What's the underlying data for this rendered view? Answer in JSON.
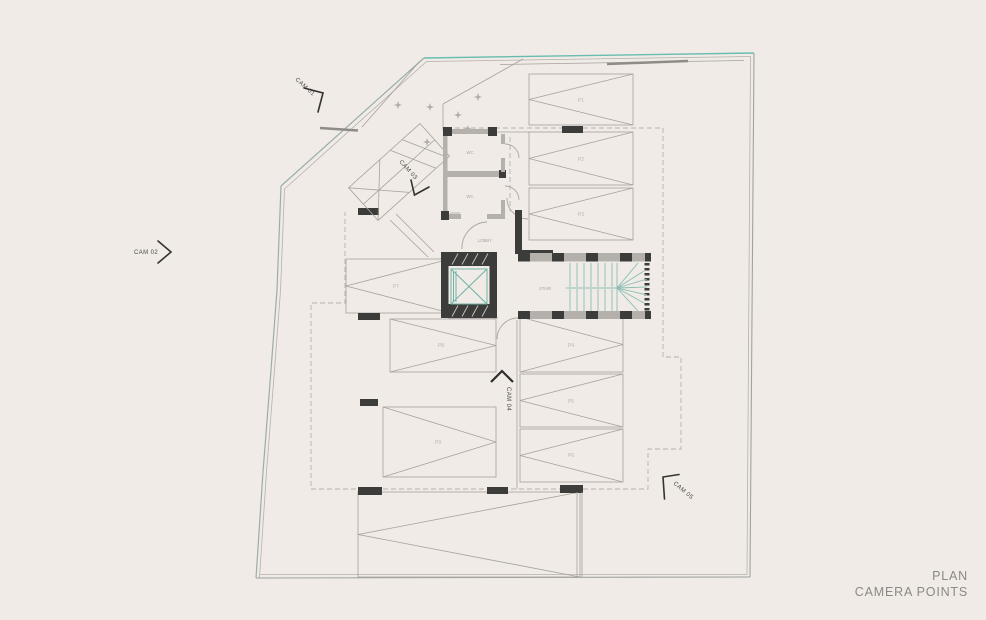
{
  "title_block": {
    "line1": "PLAN",
    "line2": "CAMERA POINTS"
  },
  "cameras": {
    "cam01": "CAM 01",
    "cam02": "CAM 02",
    "cam03": "CAM 03",
    "cam04": "CAM 04",
    "cam05": "CAM 05"
  },
  "rooms": {
    "stair": "STAIR",
    "lobby": "LOBBY",
    "wc_upper": "WC",
    "wc_lower": "WC"
  },
  "parking": {
    "p1": "P1",
    "p2": "P2",
    "p3": "P3",
    "p4": "P4",
    "p5": "P5",
    "p6": "P6",
    "p7": "P7",
    "p8": "P8",
    "p9": "P9"
  },
  "colors": {
    "background": "#f0ebe6",
    "boundary_teal": "#68bcb0",
    "stair_tread_teal": "#8abfb4",
    "elevator_teal": "#6fb3a8",
    "wall_dark": "#3c3c3a",
    "wall_gray": "#b4b0ab",
    "line_gray": "#a5a19c",
    "label_gray": "#b9b5b1",
    "cam_text": "#4a4a48",
    "title_text": "#8b8885"
  }
}
